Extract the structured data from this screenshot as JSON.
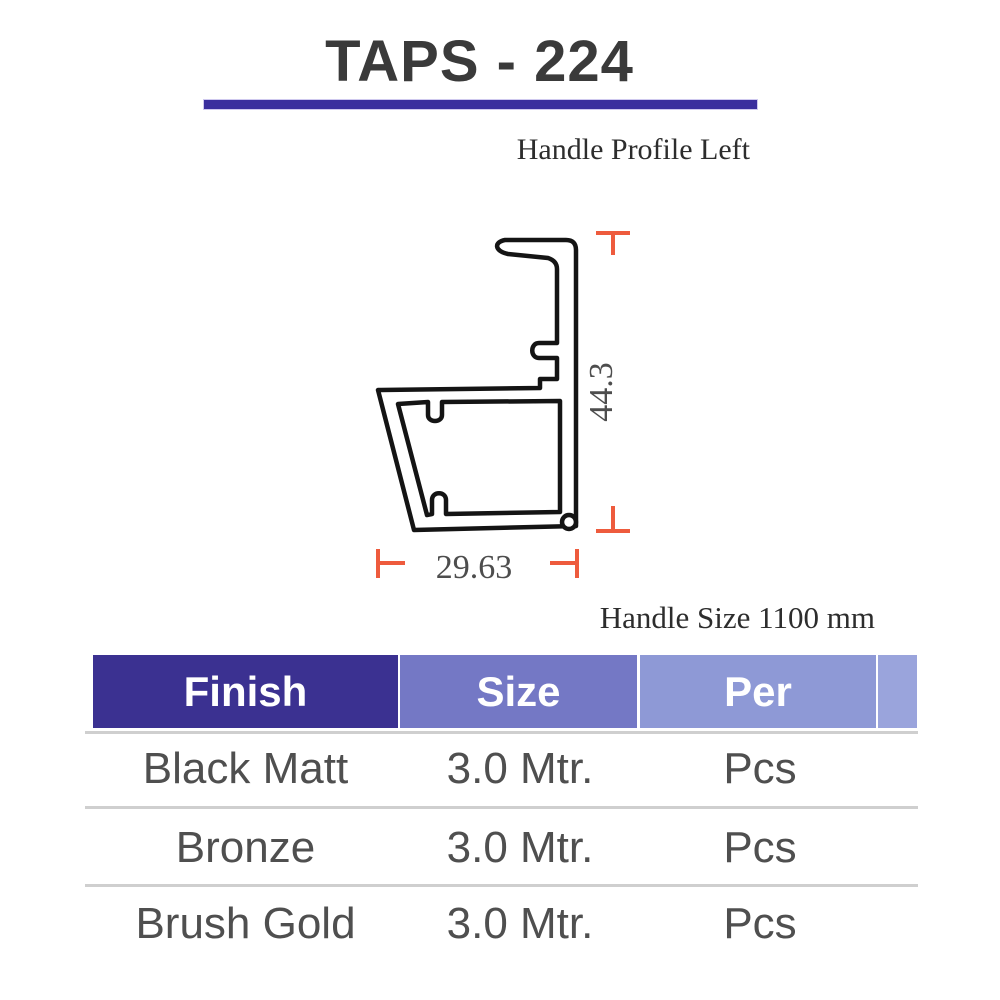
{
  "page": {
    "title": "TAPS - 224",
    "subtitle": "Handle Profile Left",
    "handle_size_note": "Handle Size 1100 mm"
  },
  "drawing": {
    "height_dim": "44.3",
    "width_dim": "29.63",
    "line_color": "#141414",
    "marker_color": "#ee5b3d",
    "dim_text_color": "#4d4d4d"
  },
  "table": {
    "headers": [
      {
        "label": "Finish",
        "bg": "#3b3191"
      },
      {
        "label": "Size",
        "bg": "#7478c5"
      },
      {
        "label": "Per",
        "bg": "#8e99d6"
      }
    ],
    "rows": [
      {
        "finish": "Black Matt",
        "size": "3.0 Mtr.",
        "per": "Pcs"
      },
      {
        "finish": "Bronze",
        "size": "3.0 Mtr.",
        "per": "Pcs"
      },
      {
        "finish": "Brush Gold",
        "size": "3.0 Mtr.",
        "per": "Pcs"
      }
    ]
  },
  "colors": {
    "title_rule": "#3b2f9e",
    "header_edge": "#9aa4dc",
    "divider": "#cfcfcf"
  }
}
